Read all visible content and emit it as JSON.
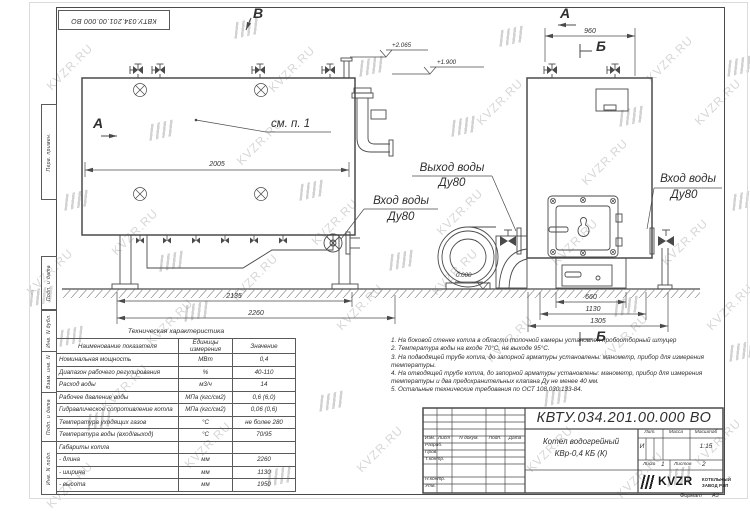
{
  "sheet": {
    "doc_number_top": "КВТУ.034.201.00.000 ВО",
    "format_label": "Формат",
    "format_value": "А3"
  },
  "watermark": {
    "text": "KVZR.RU"
  },
  "stamp_left": [
    "Перв. примен.",
    "Подп. и дата",
    "Инв. N дубл.",
    "Взам. инв. N",
    "Подп. и дата",
    "Инв. N подл."
  ],
  "views": {
    "section_a": "А",
    "section_b": "Б",
    "section_v": "В",
    "see_note": "см. п. 1",
    "outlet_label": "Выход воды",
    "outlet_dn": "Ду80",
    "inlet_label": "Вход воды",
    "inlet_dn": "Ду80",
    "inlet2_label": "Вход воды",
    "inlet2_dn": "Ду80"
  },
  "dimensions": {
    "boiler_length": "2005",
    "frame_length": "2135",
    "total_length": "2260",
    "top_width": "960",
    "base_width": "660",
    "body_width": "1130",
    "total_width": "1305"
  },
  "elevations": {
    "outlet_top": "+2.065",
    "boiler_top": "+1.900",
    "floor": "0.000"
  },
  "tech_table": {
    "title": "Техническая характеристика",
    "headers": [
      "Наименование показателя",
      "Единицы измерения",
      "Значение"
    ],
    "rows": [
      [
        "Номинальная мощность",
        "МВт",
        "0,4"
      ],
      [
        "Диапазон рабочего регулирования",
        "%",
        "40-110"
      ],
      [
        "Расход воды",
        "м3/ч",
        "14"
      ],
      [
        "Рабочее давление воды",
        "МПа (кгс/см2)",
        "0,6 (6,0)"
      ],
      [
        "Гидравлическое сопротивление котла",
        "МПа (кгс/см2)",
        "0,06 (0,6)"
      ],
      [
        "Температура уходящих газов",
        "°С",
        "не более 280"
      ],
      [
        "Температура воды (вход/выход)",
        "°С",
        "70/95"
      ],
      [
        "Габариты котла",
        "",
        ""
      ],
      [
        "- длина",
        "мм",
        "2260"
      ],
      [
        "- ширина",
        "мм",
        "1130"
      ],
      [
        "- высота",
        "мм",
        "1950"
      ]
    ]
  },
  "notes": [
    "1. На боковой стенке котла в области топочной камеры установлен пробоотборный штуцер",
    "2. Температура воды на входе 70°С, на выходе 95°С.",
    "3. На подводящей трубе котла, до запорной арматуры установлены: манометр, прибор для измерения температуры.",
    "4. На отводящей трубе котла, до запорной арматуры установлены: манометр, прибор для измерения температуры и два предохранительных клапана Ду не менее 40 мм.",
    "5. Остальные технические требования по ОСТ 108.030.133-84."
  ],
  "title_block": {
    "designation": "КВТУ.034.201.00.000  ВО",
    "name_line1": "Котел водогрейный",
    "name_line2": "КВр-0,4 КБ (К)",
    "cols": [
      "Изм.",
      "Лист",
      "N докум.",
      "Подп.",
      "Дата"
    ],
    "sig_rows": [
      "Разраб.",
      "Пров.",
      "Т.контр.",
      "Н.контр.",
      "Утв."
    ],
    "lit_label": "Лит.",
    "lit_value": "И",
    "mass_label": "Масса",
    "scale_label": "Масштаб",
    "scale_value": "1:15",
    "sheet_label": "Лист",
    "sheet_value": "1",
    "sheets_label": "Листов",
    "sheets_value": "2",
    "logo_text": "KVZR",
    "logo_sub1": "КОТЕЛЬНЫЙ",
    "logo_sub2": "ЗАВОД РЭП"
  }
}
